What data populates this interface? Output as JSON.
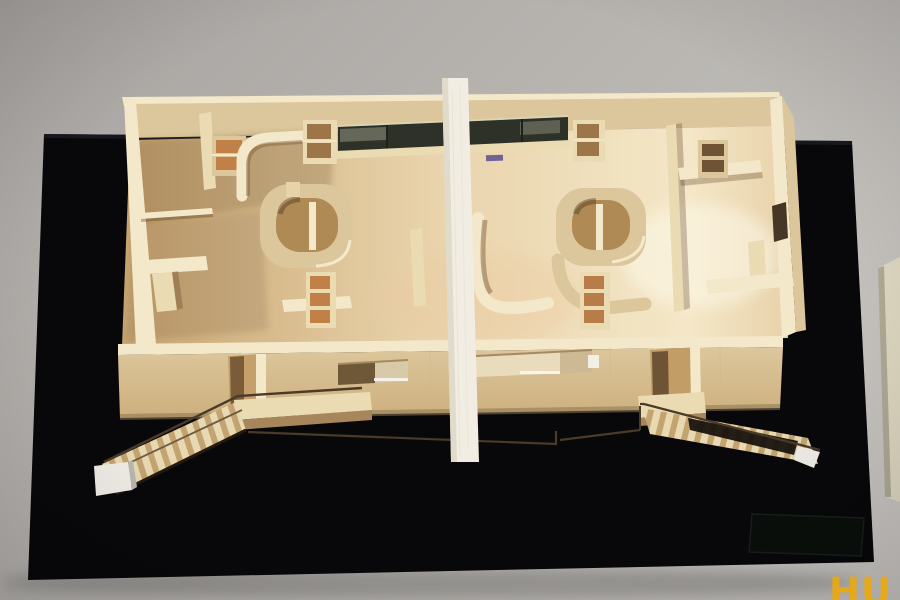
{
  "watermark": {
    "text": "HU"
  },
  "colors": {
    "wall_top": "#a7a3a0",
    "wall_mid": "#b8b5b1",
    "wall_bottom": "#cac7c3",
    "base_black": "#08080b",
    "base_edge": "#1c1c24",
    "plaque_face": "#0b100d",
    "plaque_line": "#182119",
    "wood_bright": "#f4e8ca",
    "wood_light": "#eadbb3",
    "wood_mid": "#dcc79c",
    "wood_tan": "#cdaf7e",
    "wood_dark": "#b08a54",
    "wood_shadow": "#8a6a42",
    "opening_dark": "#6e5434",
    "floor_left": "#c7a470",
    "floor_center": "#e8d2aa",
    "floor_right": "#f4e7c7",
    "glazing": "#2e3127",
    "glazing_hi": "#787b6a",
    "divider": "#f1ede2",
    "divider_shade": "#ddd7c6",
    "rail": "#4a3a28",
    "stair_light": "#e9d9b2",
    "stair_dark": "#c3a470",
    "pad_white": "#efede6",
    "side_object": "#dcd6c0",
    "label_purple": "#5a4e8c",
    "watermark": "#eaa90f"
  }
}
